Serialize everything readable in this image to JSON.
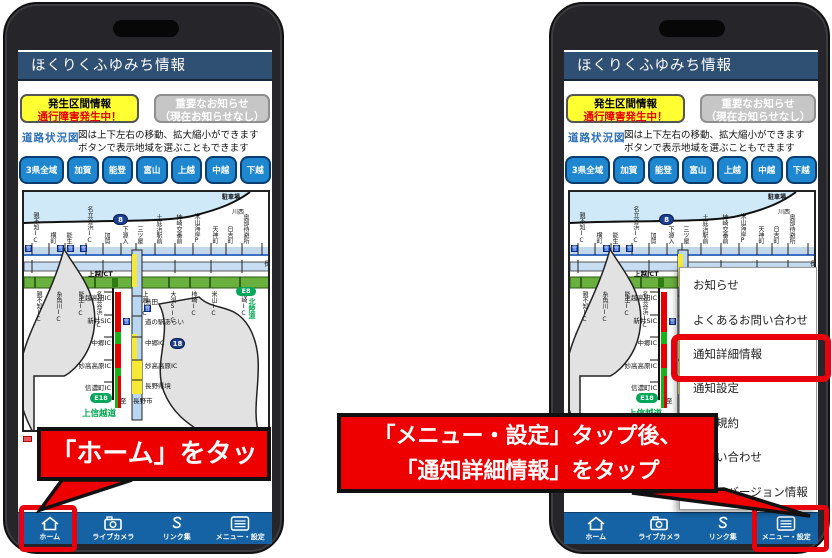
{
  "app": {
    "title": "ほくりくふゆみち情報"
  },
  "buttons": {
    "incident": {
      "line1": "発生区間情報",
      "line2": "通行障害発生中！"
    },
    "notice": {
      "line1": "重要なお知らせ",
      "line2": "（現在お知らせなし）"
    }
  },
  "roadmap": {
    "label": "道路状況図",
    "desc1": "図は上下左右の移動、拡大縮小ができます",
    "desc2": "ボタンで表示地域を選ぶこともできます"
  },
  "regions": [
    "3県全域",
    "加賀",
    "能登",
    "富山",
    "上越",
    "中越",
    "下越"
  ],
  "map": {
    "parking": "駐車場",
    "kawanishi": "川西",
    "nagaoka": "長",
    "joetsu_jct": "上越JCT",
    "route8": "8",
    "route18": "18",
    "e18": "E18",
    "e8": "E8",
    "hokurikudo": "北陸道",
    "to_nagano": "至　長野市",
    "shinetsudo": "上信越道",
    "top_stations": [
      {
        "t": "親不知IC",
        "css": {
          "left": "8px"
        }
      },
      {
        "t": "横町",
        "css": {
          "left": "25px"
        }
      },
      {
        "t": "能生",
        "css": {
          "left": "41px"
        }
      },
      {
        "t": "名立谷浜IC",
        "css": {
          "left": "62px"
        }
      },
      {
        "t": "加賀",
        "css": {
          "left": "79px"
        }
      },
      {
        "t": "下源入",
        "css": {
          "left": "97px"
        }
      },
      {
        "t": "三ツ屋",
        "css": {
          "left": "112px"
        }
      },
      {
        "t": "土底浜駅前",
        "css": {
          "left": "131px"
        }
      },
      {
        "t": "柿崎交番前",
        "css": {
          "left": "151px"
        }
      },
      {
        "t": "米山海岸P",
        "css": {
          "left": "169px"
        }
      },
      {
        "t": "天神町",
        "css": {
          "left": "187px"
        }
      },
      {
        "t": "日吉町",
        "css": {
          "left": "202px"
        }
      },
      {
        "t": "奥部待避所",
        "css": {
          "left": "218px"
        }
      }
    ],
    "ic_stations": [
      {
        "t": "親不知IC",
        "css": {
          "left": "11px"
        }
      },
      {
        "t": "糸魚川IC",
        "css": {
          "left": "31px"
        }
      },
      {
        "t": "能生IC",
        "css": {
          "left": "53px"
        }
      },
      {
        "t": "名立谷浜IC",
        "css": {
          "left": "71px"
        }
      },
      {
        "t": "上越IC",
        "css": {
          "left": "117px"
        }
      },
      {
        "t": "大潟SIC",
        "css": {
          "left": "145px"
        }
      },
      {
        "t": "柿崎IC",
        "css": {
          "left": "166px"
        }
      },
      {
        "t": "米山IC",
        "css": {
          "left": "186px"
        }
      },
      {
        "t": "柏崎IC",
        "css": {
          "left": "216px"
        }
      }
    ],
    "left_road_labels": [
      {
        "t": "上越高田IC",
        "css": {
          "left": "87px",
          "top": "100px"
        }
      },
      {
        "t": "新井SIC",
        "css": {
          "left": "87px",
          "top": "123px"
        }
      },
      {
        "t": "中郷IC",
        "css": {
          "left": "87px",
          "top": "145px"
        }
      },
      {
        "t": "妙高高原IC",
        "css": {
          "left": "87px",
          "top": "168px"
        }
      },
      {
        "t": "信濃町IC",
        "css": {
          "left": "87px",
          "top": "190px"
        }
      }
    ],
    "right_road_labels": [
      {
        "t": "島田",
        "css": {
          "left": "121px",
          "top": "104px"
        }
      },
      {
        "t": "道の駅あらい",
        "css": {
          "left": "121px",
          "top": "124px"
        }
      },
      {
        "t": "中郷IC",
        "css": {
          "left": "121px",
          "top": "145px"
        }
      },
      {
        "t": "妙高高原IC",
        "css": {
          "left": "121px",
          "top": "168px"
        }
      },
      {
        "t": "長野県境",
        "css": {
          "left": "121px",
          "top": "188px"
        }
      }
    ],
    "chain_icons": [
      {
        "t": "雪",
        "css": {
          "left": "1px",
          "top": "53px"
        }
      },
      {
        "t": "雪",
        "css": {
          "left": "33px",
          "top": "53px"
        }
      },
      {
        "t": "雪",
        "css": {
          "left": "43px",
          "top": "53px"
        }
      },
      {
        "t": "雪",
        "css": {
          "left": "56px",
          "top": "53px"
        }
      },
      {
        "t": "雪",
        "css": {
          "left": "99px",
          "top": "126px"
        }
      },
      {
        "t": "雪",
        "css": {
          "left": "120px",
          "top": "113px"
        }
      }
    ]
  },
  "nav": {
    "items": [
      {
        "label": "ホーム",
        "icon": "home-icon"
      },
      {
        "label": "ライブカメラ",
        "icon": "camera-icon"
      },
      {
        "label": "リンク集",
        "icon": "link-icon"
      },
      {
        "label": "メニュー・設定",
        "icon": "menu-icon"
      }
    ]
  },
  "menu": {
    "items": [
      "お知らせ",
      "よくあるお問い合わせ",
      "通知詳細情報",
      "通知設定",
      "利用規約",
      "お問い合わせ",
      "アプリバージョン情報"
    ]
  },
  "callouts": {
    "left": "「ホーム」をタップ",
    "right_line1": "「メニュー・設定」タップ後、",
    "right_line2": "「通知詳細情報」をタップ"
  },
  "colors": {
    "accent_red": "#e8000d",
    "header_navy": "#2f4f73",
    "navbar_blue": "#1563a5",
    "region_blue": "#1e87cf",
    "alert_yellow": "#ffff31",
    "closed_red": "#e60000",
    "open_green": "#19b319",
    "caution_yellow": "#f5e933"
  }
}
